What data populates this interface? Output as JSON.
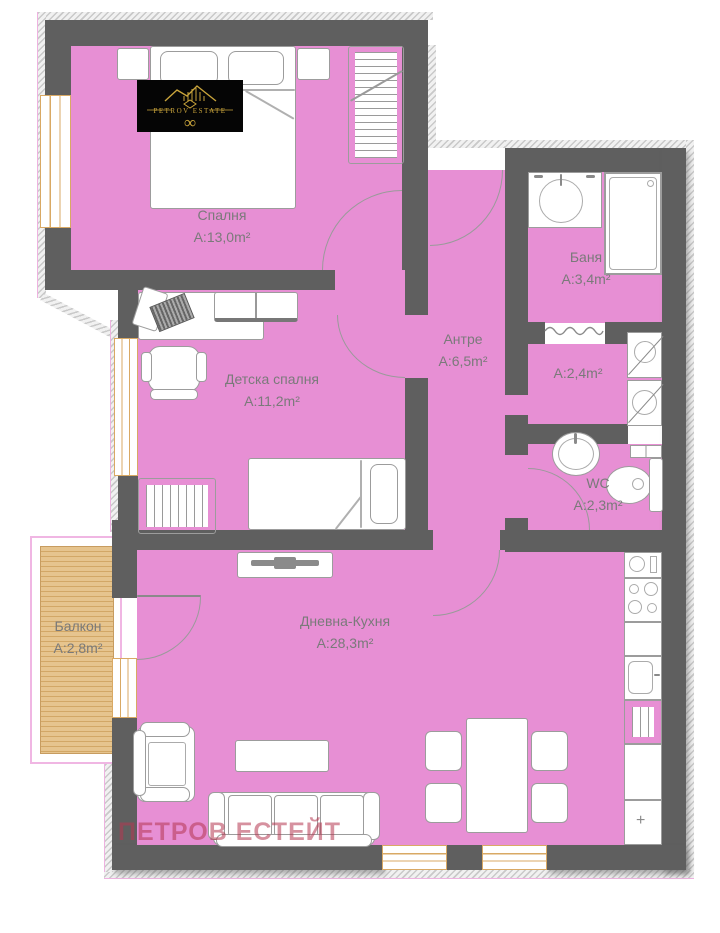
{
  "page": {
    "background": "#ffffff",
    "kind": "apartment floor plan"
  },
  "branding": {
    "logo_text": "PETROV ESTATE",
    "logo_symbol": "∞",
    "watermark": "ПЕТРОВ ЕСТЕЙТ"
  },
  "rooms": [
    {
      "id": "bedroom",
      "name": "Спалня",
      "area": "A:13,0m²"
    },
    {
      "id": "kids-bedroom",
      "name": "Детска спалня",
      "area": "A:11,2m²"
    },
    {
      "id": "hallway",
      "name": "Антре",
      "area": "A:6,5m²"
    },
    {
      "id": "bathroom",
      "name": "Баня",
      "area": "A:3,4m²"
    },
    {
      "id": "laundry",
      "name": "",
      "area": "A:2,4m²"
    },
    {
      "id": "wc",
      "name": "WC",
      "area": "A:2,3m²"
    },
    {
      "id": "living-kitchen",
      "name": "Дневна-Кухня",
      "area": "A:28,3m²"
    },
    {
      "id": "balcony",
      "name": "Балкон",
      "area": "A:2,8m²"
    }
  ],
  "colors": {
    "room_fill": "#e78fd4",
    "walls": "#5f5f5f",
    "balcony_deck": "#ddb57e",
    "window_frame": "#d9a964",
    "label_text": "#7a7a7a",
    "watermark": "#b53650",
    "logo_background": "#050505",
    "logo_gold": "#c9a43b"
  }
}
